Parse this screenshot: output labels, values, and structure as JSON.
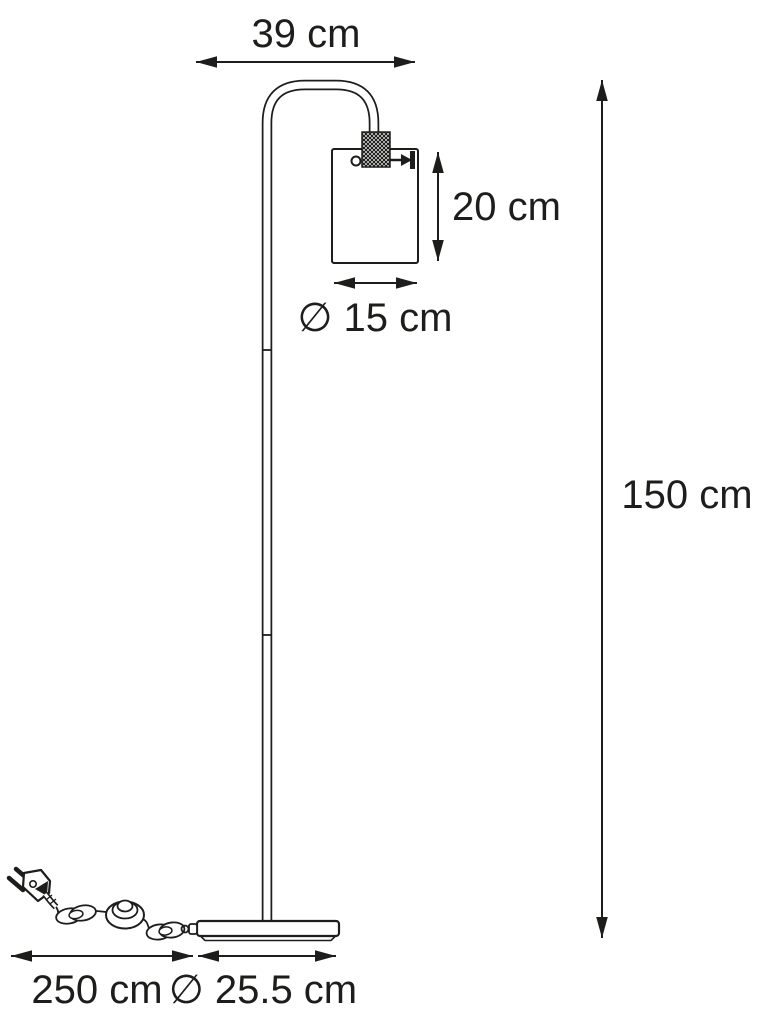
{
  "diagram": {
    "background_color": "#ffffff",
    "line_color": "#1d1d1b",
    "dimensions": {
      "arm_width": {
        "value": 39,
        "unit": "cm",
        "label": "39 cm"
      },
      "shade_height": {
        "value": 20,
        "unit": "cm",
        "label": "20 cm"
      },
      "shade_diameter": {
        "value": 15,
        "unit": "cm",
        "label": "∅ 15 cm"
      },
      "lamp_height": {
        "value": 150,
        "unit": "cm",
        "label": "150 cm"
      },
      "cable_length": {
        "value": 250,
        "unit": "cm",
        "label": "250 cm"
      },
      "base_diameter": {
        "value": 25.5,
        "unit": "cm",
        "label": "∅ 25.5 cm"
      }
    }
  }
}
